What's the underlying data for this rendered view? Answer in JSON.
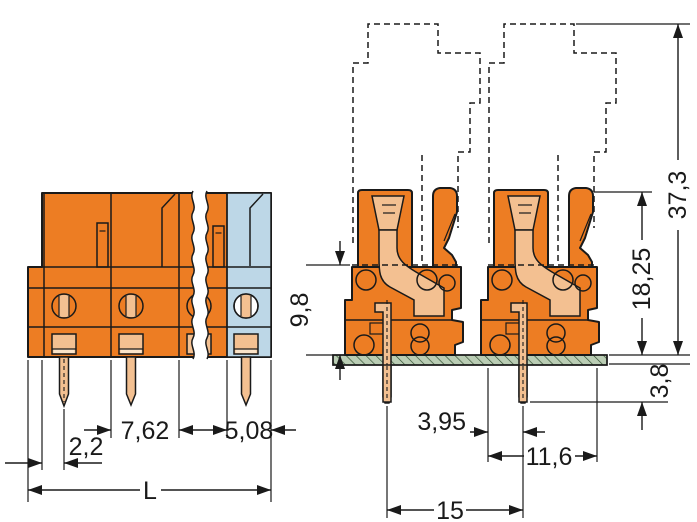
{
  "drawing": {
    "description": "Technical dimensional drawing of an orange PCB female header terminal strip (front view with break symbol and blue end section, plus side view of two poles on a green PCB with dashed mating-plug outline)",
    "views": {
      "front": "front-view",
      "side": "side-view-on-pcb"
    },
    "dimensions": {
      "pin_offset": "2,2",
      "pitch": "7,62",
      "last_pitch": "5,08",
      "total_length": "L",
      "plug_depth": "9,8",
      "header_height": "18,25",
      "total_height": "37,3",
      "pin_length_below_board": "3,8",
      "pin_to_front": "3,95",
      "housing_depth": "11,6",
      "pole_spacing": "15"
    },
    "colors": {
      "housing_orange": "#ED7D23",
      "contact_tan": "#F3C091",
      "end_plate_blue": "#BDD7E7",
      "pcb_green": "#BACDB4",
      "line": "#1a1a1a"
    }
  }
}
